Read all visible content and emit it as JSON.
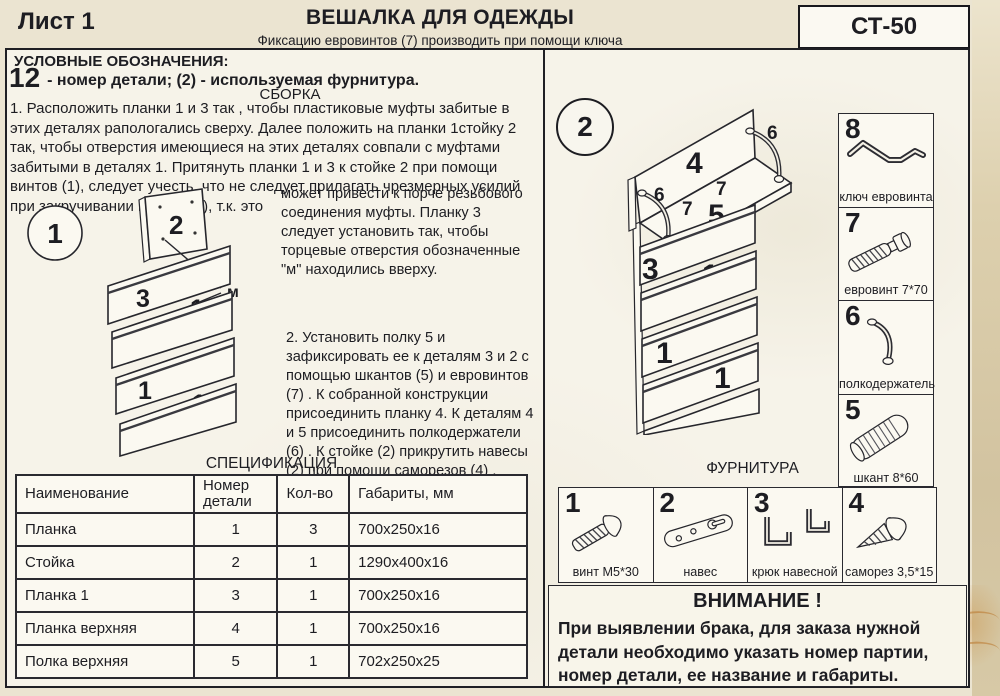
{
  "header": {
    "sheet_label": "Лист 1",
    "title": "ВЕШАЛКА ДЛЯ ОДЕЖДЫ",
    "subtitle": "Фиксацию евровинтов (7) производить при помощи ключа евровинта (8)",
    "model": "СТ-50"
  },
  "legend": {
    "heading": "УСЛОВНЫЕ ОБОЗНАЧЕНИЯ:",
    "big_number": "12",
    "rest": "- номер детали;  (2) - используемая фурнитура.",
    "assembly_heading": "СБОРКА"
  },
  "instructions": {
    "step1": "1. Расположить планки  1  и 3 так , чтобы пластиковые муфты забитые в этих деталях рапологались сверху.  Далее  положить на планки 1стойку 2 так, чтобы отверстия имеющиеся на этих деталях совпали с муфтами забитыми в деталях 1. Притянуть планки 1 и 3 к стойке 2 при помощи винтов (1), следует учесть, что не следует прилагать чрезмерных усилий при закручивании винтов (1), т.к. это",
    "step1_cont": "может привести к порче резьбового соединения муфты. Планку 3 следует установить так, чтобы торцевые отверстия обозначенные \"м\" находились вверху.",
    "step2": "2. Установить полку 5 и зафиксировать ее к деталям 3 и 2 с помощью шкантов  (5)  и евровинтов  (7) . К собранной конструкции присоединить планку 4. К деталям 4 и 5 присоединить полкодержатели  (6) . К стойке  (2) прикрутить навесы  (2)  при помощи саморезов  (4) ."
  },
  "diagrams": {
    "d1": {
      "badge": "1",
      "board": "2",
      "p1": "3",
      "p2": "1",
      "p3": "1",
      "p4": "1",
      "marker": "м"
    },
    "d2": {
      "badge": "2",
      "board": "4",
      "shelf": "5",
      "support": "6",
      "screw": "7",
      "p1": "3",
      "p2": "1",
      "p3": "1",
      "p4": "1"
    }
  },
  "spec": {
    "title": "СПЕЦИФИКАЦИЯ",
    "headers": [
      "Наименование",
      "Номер детали",
      "Кол-во",
      "Габариты, мм"
    ],
    "rows": [
      [
        "Планка",
        "1",
        "3",
        "700x250x16"
      ],
      [
        "Стойка",
        "2",
        "1",
        "1290x400x16"
      ],
      [
        "Планка 1",
        "3",
        "1",
        "700x250x16"
      ],
      [
        "Планка верхняя",
        "4",
        "1",
        "700x250x16"
      ],
      [
        "Полка верхняя",
        "5",
        "1",
        "702x250x25"
      ]
    ]
  },
  "hardware": {
    "items": [
      {
        "num": "8",
        "label": "ключ евровинта",
        "icon": "hex-key-icon"
      },
      {
        "num": "7",
        "label": "евровинт 7*70",
        "icon": "confirmat-screw-icon"
      },
      {
        "num": "6",
        "label": "полкодержатель",
        "icon": "shelf-support-icon"
      },
      {
        "num": "5",
        "label": "шкант 8*60",
        "icon": "dowel-icon"
      }
    ]
  },
  "fittings": {
    "title": "ФУРНИТУРА",
    "items": [
      {
        "num": "1",
        "label": "винт М5*30",
        "icon": "machine-screw-icon"
      },
      {
        "num": "2",
        "label": "навес",
        "icon": "hanging-plate-icon"
      },
      {
        "num": "3",
        "label": "крюк навесной",
        "icon": "wall-hook-icon"
      },
      {
        "num": "4",
        "label": "саморез 3,5*15",
        "icon": "self-tapping-screw-icon"
      }
    ]
  },
  "warning": {
    "title": "ВНИМАНИЕ !",
    "text": "При выявлении брака, для заказа нужной детали необходимо указать номер партии, номер детали, ее название и габариты."
  },
  "colors": {
    "ink": "#1d1d22",
    "paper": "#f6f3e9",
    "scan_margin": "#d2c3a0"
  }
}
